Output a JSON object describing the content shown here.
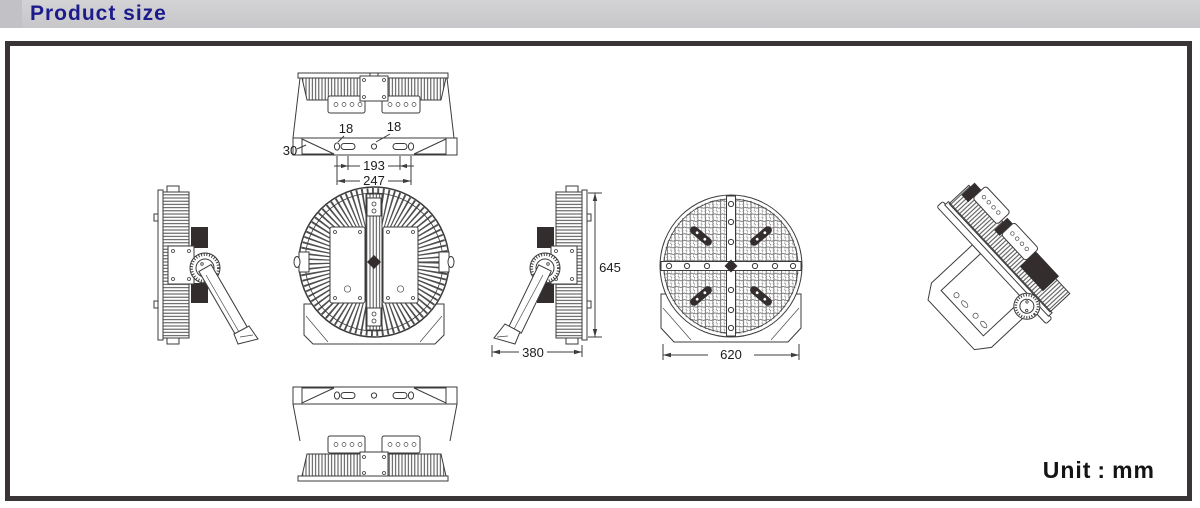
{
  "header": {
    "title": "Product size"
  },
  "unit": {
    "label": "Unit",
    "separator": ":",
    "value": "mm"
  },
  "dimensions": {
    "top_left_hole": "18",
    "top_right_hole": "18",
    "top_slot_span": "193",
    "top_outer_span": "247",
    "bracket_strip": "30",
    "overall_height": "645",
    "overall_depth": "380",
    "face_diameter": "620"
  },
  "colors": {
    "header_bg": "#cdcdcf",
    "title_text": "#1c1b8b",
    "frame_border": "#393435",
    "line_work": "#3b3b3b"
  }
}
